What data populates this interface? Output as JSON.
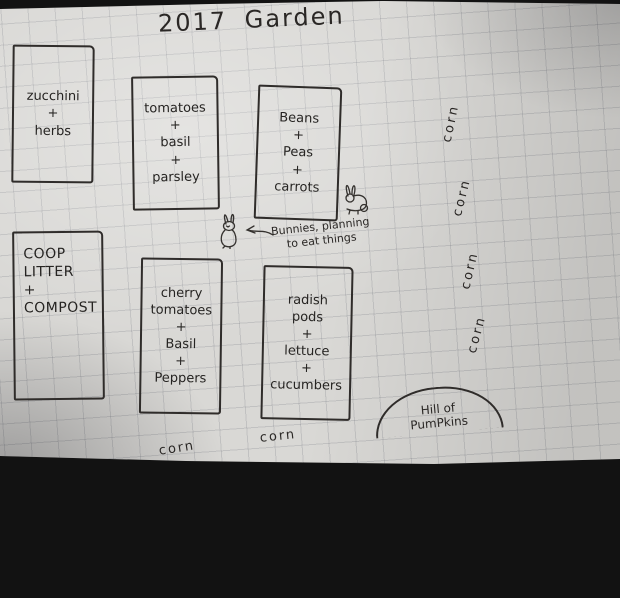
{
  "photo": {
    "title": "2017 Garden"
  },
  "beds": [
    {
      "name": "zucchini-herbs",
      "label": "zucchini\n+\nherbs"
    },
    {
      "name": "tomatoes-basil-parsley",
      "label": "tomatoes\n+\nbasil\n+\nparsley"
    },
    {
      "name": "beans-peas-carrots",
      "label": "Beans\n+\nPeas\n+\ncarrots"
    },
    {
      "name": "coop-litter-compost",
      "label": "COOP\nLITTER\n+\nCOMPOST"
    },
    {
      "name": "cherry-tomatoes-basil-peppers",
      "label": "cherry\ntomatoes\n+\nBasil\n+\nPeppers"
    },
    {
      "name": "radish-pods-lettuce-cucumbers",
      "label": "radish\npods\n+\nlettuce\n+\ncucumbers"
    }
  ],
  "corn": {
    "right": [
      "corn",
      "corn",
      "corn",
      "corn"
    ],
    "bottom": [
      "corn",
      "corn"
    ]
  },
  "annotations": {
    "bunnies_note": "Bunnies, planning\nto eat things",
    "pumpkin_hill": "Hill of\nPumPkins"
  },
  "colors": {
    "paper": "#d9d8d5",
    "ink": "#2a2725",
    "grid_line": "#aeb0b6",
    "background": "#121212"
  }
}
